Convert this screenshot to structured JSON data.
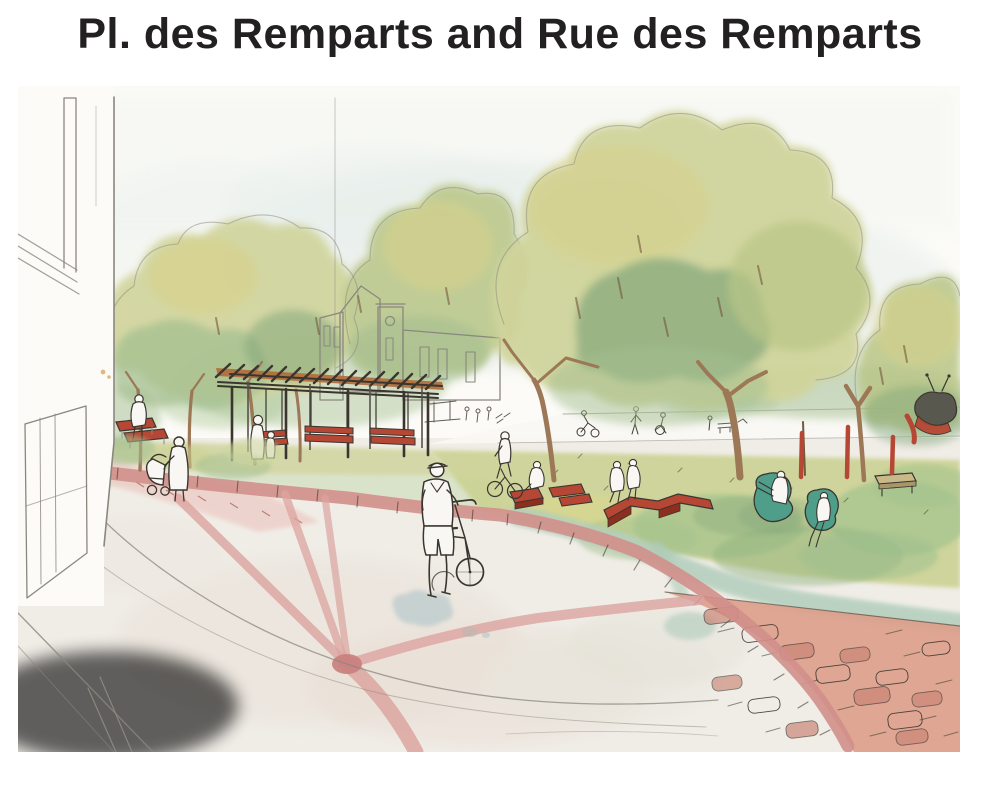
{
  "header": {
    "title": "Pl. des Remparts and Rue des Remparts"
  },
  "illustration": {
    "palette": {
      "titleColor": "#232021",
      "paper": "#fcfbf7",
      "pencil": "#8a877e",
      "ink": "#3a362f",
      "skyWash": "#dfe9e6",
      "sunWash": "#f0e9d2",
      "treeLight": "#d0d49b",
      "treeYellow": "#d8d18a",
      "treeMid": "#b9c687",
      "treeSage": "#a4bf90",
      "treeDeep": "#7da377",
      "trunk": "#9c7857",
      "trunkDark": "#74573c",
      "slatWood": "#b06a38",
      "benchRed": "#b64734",
      "benchRedDark": "#8c2f1f",
      "pathPink": "#dca4a0",
      "pathPinkSoft": "#ecc9c3",
      "curbPink": "#d28f8b",
      "pavingSalmon": "#db9d89",
      "pavingStone": "#c98374",
      "lawnYellow": "#cbd293",
      "lawnGreen": "#a6c48e",
      "lawnTeal": "#afccba",
      "groundSage": "#dbe5d0",
      "poufTeal": "#4f9e8a",
      "plazaGray": "#f0ede7",
      "plazaWarm": "#e9ddd4",
      "puddleBlue": "#a9c0c6",
      "figureWhite": "#f8f7f3",
      "benchWood": "#c9b888"
    }
  }
}
